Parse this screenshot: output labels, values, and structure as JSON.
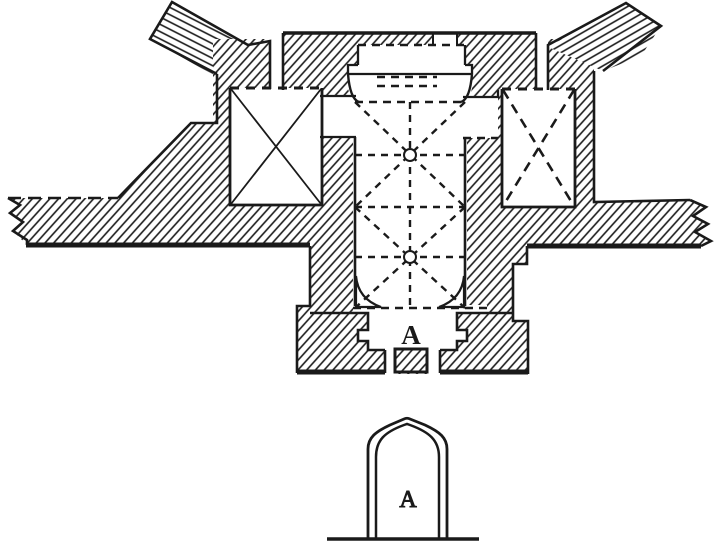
{
  "figure": {
    "plan": {
      "entrance_label": "A"
    },
    "elevation": {
      "entrance_label": "A"
    },
    "colors": {
      "ink": "#1a1a1a",
      "paper": "#ffffff"
    }
  }
}
